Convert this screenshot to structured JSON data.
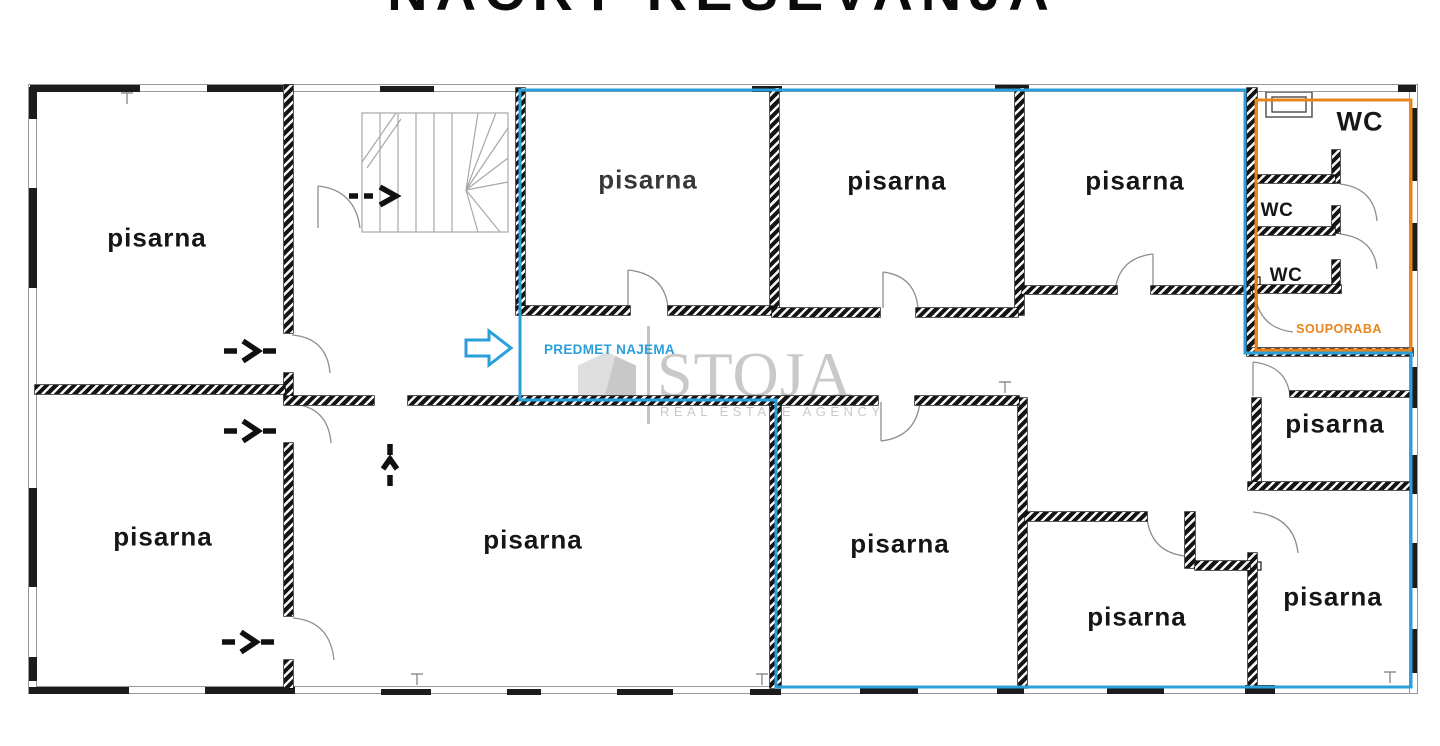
{
  "title": "NAČRT REŠEVANJA",
  "watermark": {
    "brand": "STOJA",
    "tagline": "REAL ESTATE AGENCY"
  },
  "overlays": {
    "lease": {
      "label": "PREDMET NAJEMA",
      "color": "#2b9fd9"
    },
    "shared": {
      "label": "SOUPORABA",
      "color": "#e8841d"
    }
  },
  "rooms": [
    {
      "id": "office-top-left",
      "label": "pisarna"
    },
    {
      "id": "office-top-1",
      "label": "pisarna"
    },
    {
      "id": "office-top-2",
      "label": "pisarna"
    },
    {
      "id": "office-top-3",
      "label": "pisarna"
    },
    {
      "id": "office-right-mid",
      "label": "pisarna"
    },
    {
      "id": "office-bottom-left",
      "label": "pisarna"
    },
    {
      "id": "office-bottom-center",
      "label": "pisarna"
    },
    {
      "id": "office-bottom-mid",
      "label": "pisarna"
    },
    {
      "id": "office-bottom-inner",
      "label": "pisarna"
    },
    {
      "id": "office-bottom-right",
      "label": "pisarna"
    }
  ],
  "wc": {
    "main": "WC",
    "stall_a": "WC",
    "stall_b": "WC"
  }
}
